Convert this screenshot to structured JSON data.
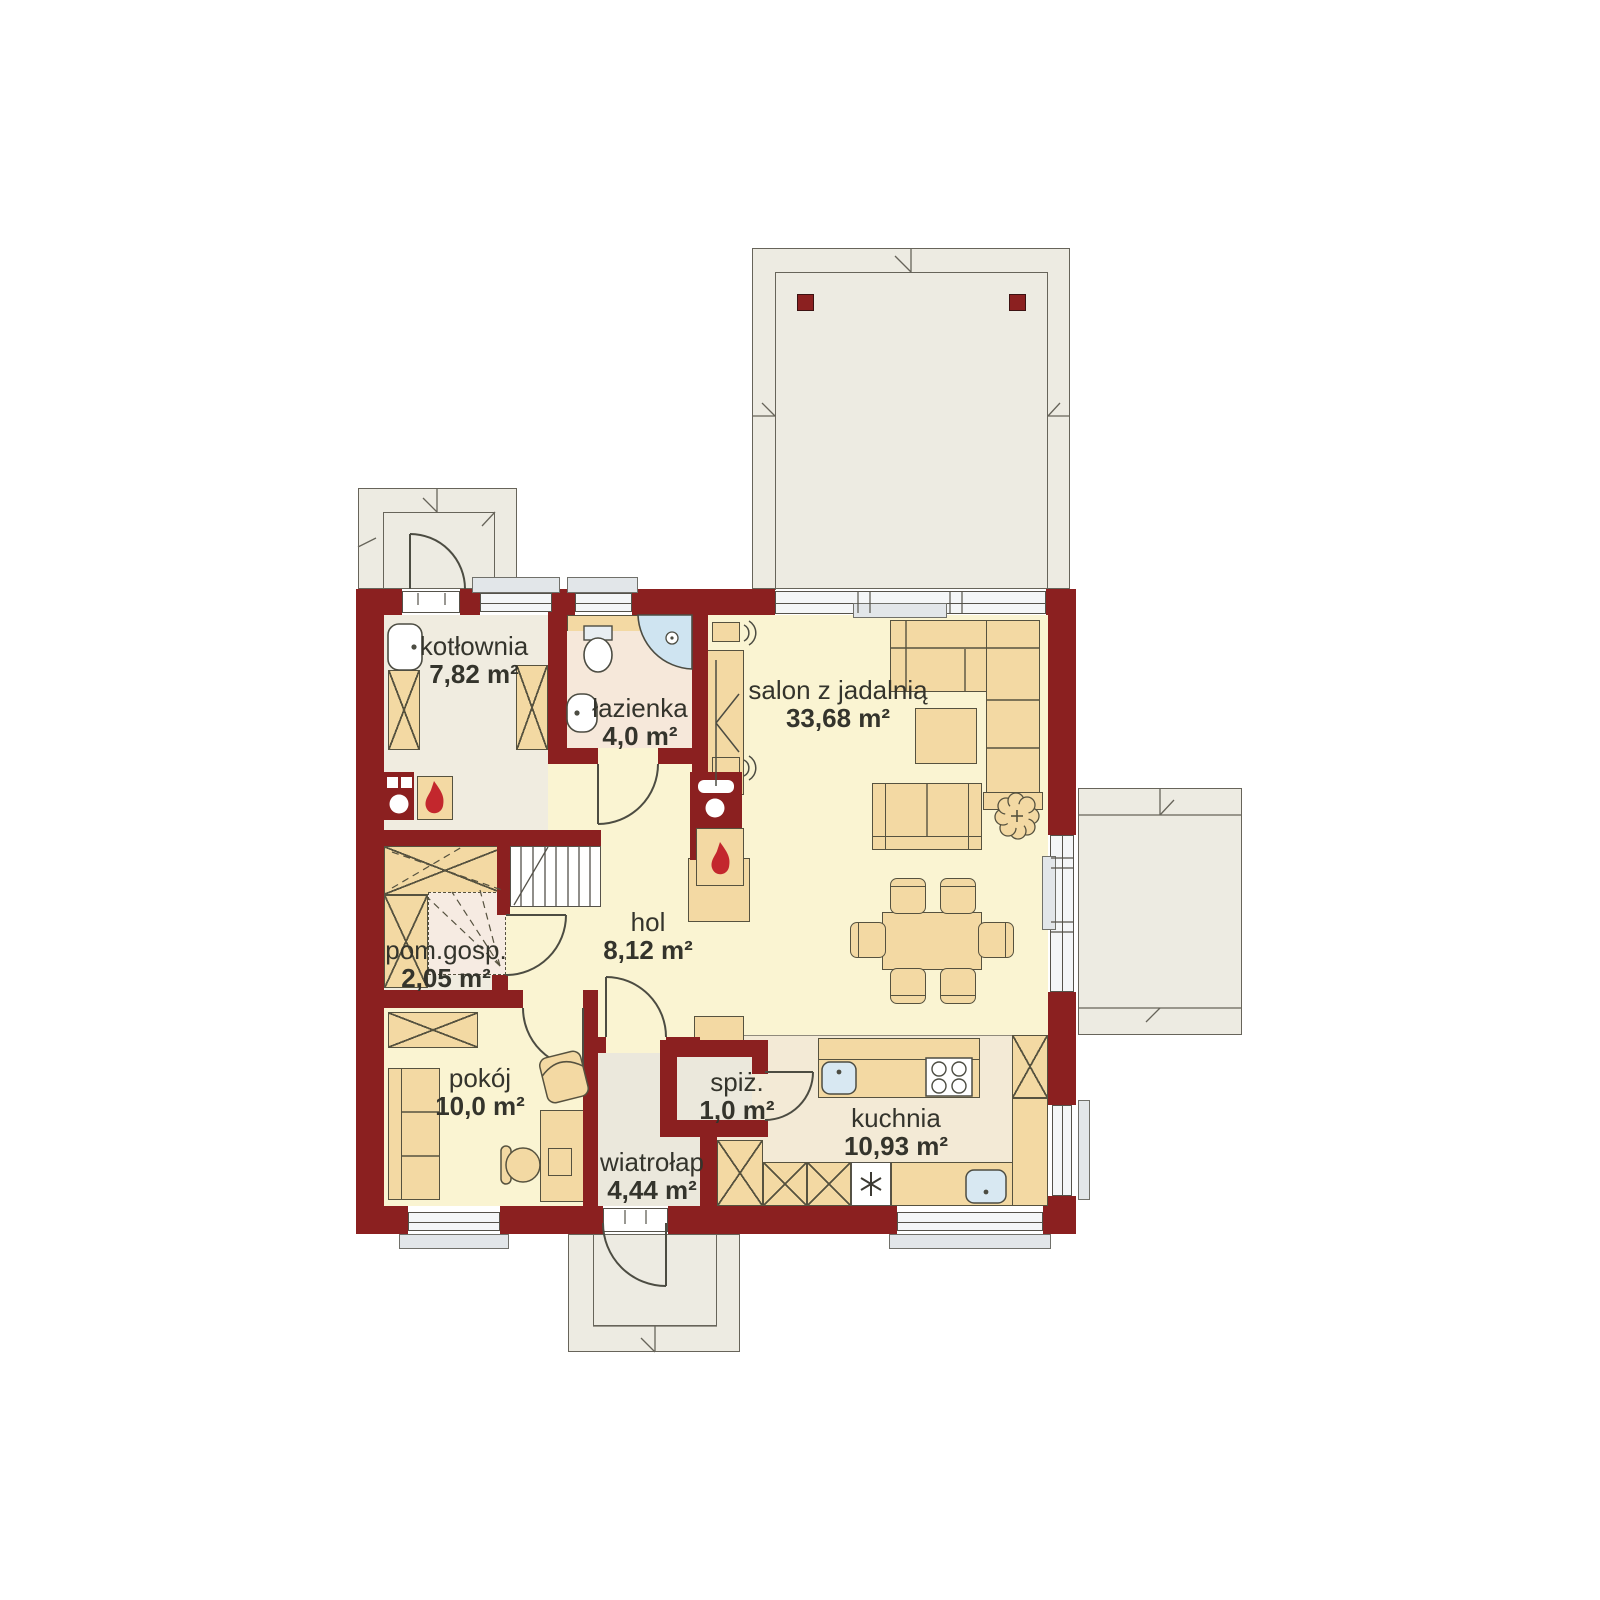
{
  "plan_title": "parter - rzut kondygnacji",
  "rooms": [
    {
      "id": "kotlownia",
      "name": "kotłownia",
      "area": "7,82 m²"
    },
    {
      "id": "lazienka",
      "name": "łazienka",
      "area": "4,0 m²"
    },
    {
      "id": "salon",
      "name": "salon z jadalnią",
      "area": "33,68 m²"
    },
    {
      "id": "pom_gosp",
      "name": "pom.gosp.",
      "area": "2,05 m²"
    },
    {
      "id": "hol",
      "name": "hol",
      "area": "8,12 m²"
    },
    {
      "id": "pokoj",
      "name": "pokój",
      "area": "10,0 m²"
    },
    {
      "id": "wiatrolap",
      "name": "wiatrołap",
      "area": "4,44 m²"
    },
    {
      "id": "spiz",
      "name": "spiż.",
      "area": "1,0 m²"
    },
    {
      "id": "kuchnia",
      "name": "kuchnia",
      "area": "10,93 m²"
    }
  ],
  "colors": {
    "wall": "#8b2020",
    "terrace": "#edebe2",
    "floor_main": "#faf4d2",
    "floor_service": "#f0ece0",
    "floor_bath": "#f6e8da",
    "floor_kitchen": "#f3ead6",
    "floor_entry": "#ebe8dc",
    "furniture": "#f3d9a3",
    "glass": "#f4f6f7",
    "flame": "#c3272d"
  }
}
